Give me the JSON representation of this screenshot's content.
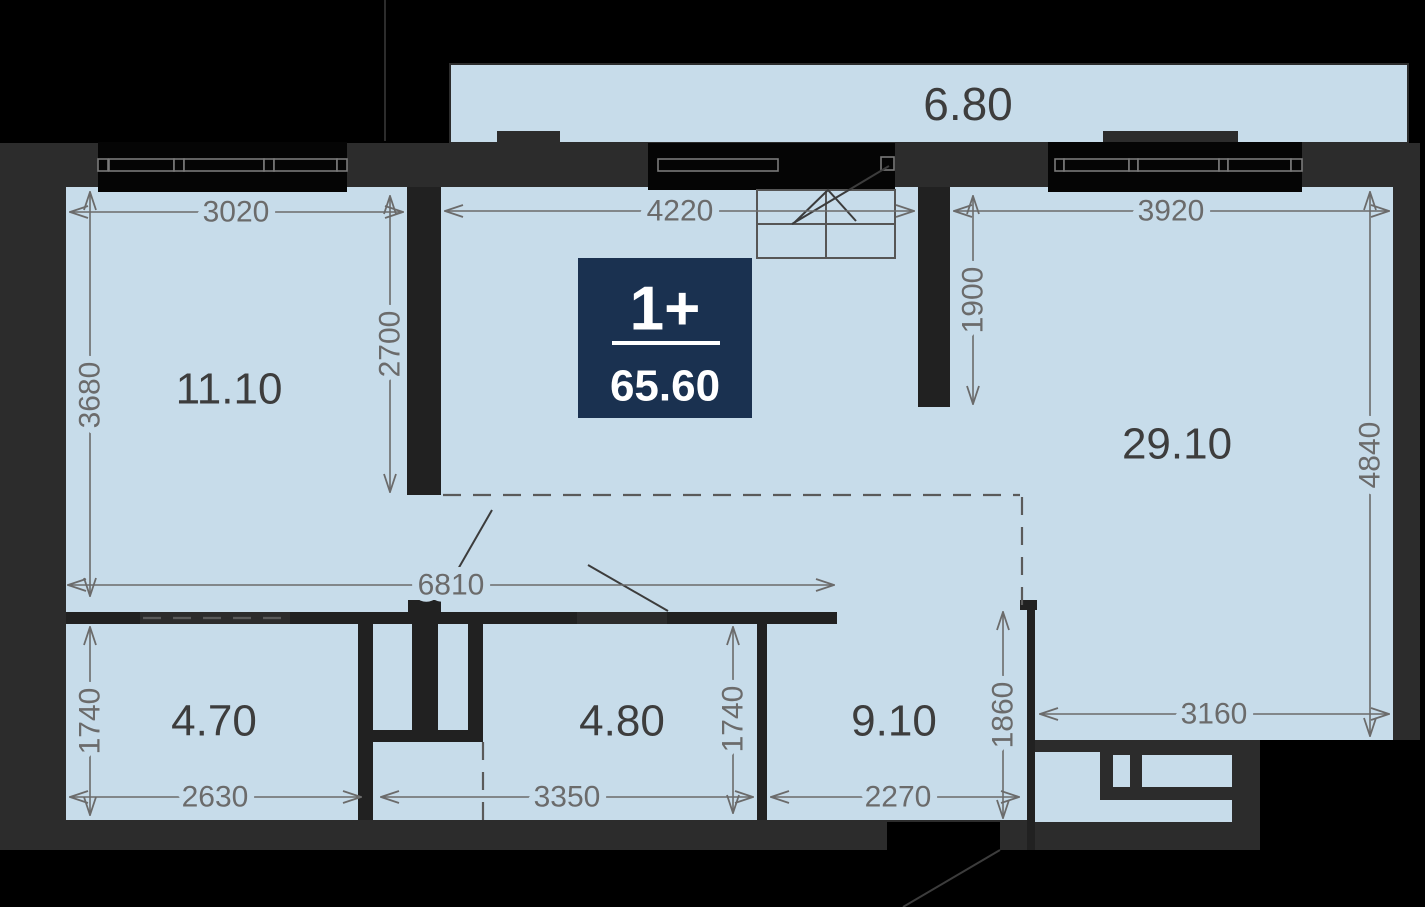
{
  "badge": {
    "rooms": "1+",
    "area": "65.60"
  },
  "areas": {
    "balcony": "6.80",
    "top_left": "11.10",
    "living": "29.10",
    "bottom_left": "4.70",
    "bottom_middle": "4.80",
    "hallway": "9.10"
  },
  "dims": {
    "top_left_width": "3020",
    "corridor_width": "4220",
    "living_width": "3920",
    "top_left_height": "3680",
    "inner_wall_height": "2700",
    "stub_height": "1900",
    "living_height": "4840",
    "corridor_span": "6810",
    "bottom_left_height": "1740",
    "bottom_left_width": "2630",
    "bottom_middle_width": "3350",
    "bottom_middle_height": "1740",
    "hallway_width": "2270",
    "hallway_height": "1860",
    "kitchen_width": "3160"
  },
  "colors": {
    "background": "#000000",
    "wall": "#2c2c2c",
    "wall_dark": "#1f1f1f",
    "room_fill": "#c7dcea",
    "dim_text": "#6b6b6b",
    "room_label": "#3d3d3d",
    "badge_bg": "#1a3150",
    "window_frame": "#7a7a7a",
    "badge_text": "#ffffff"
  }
}
